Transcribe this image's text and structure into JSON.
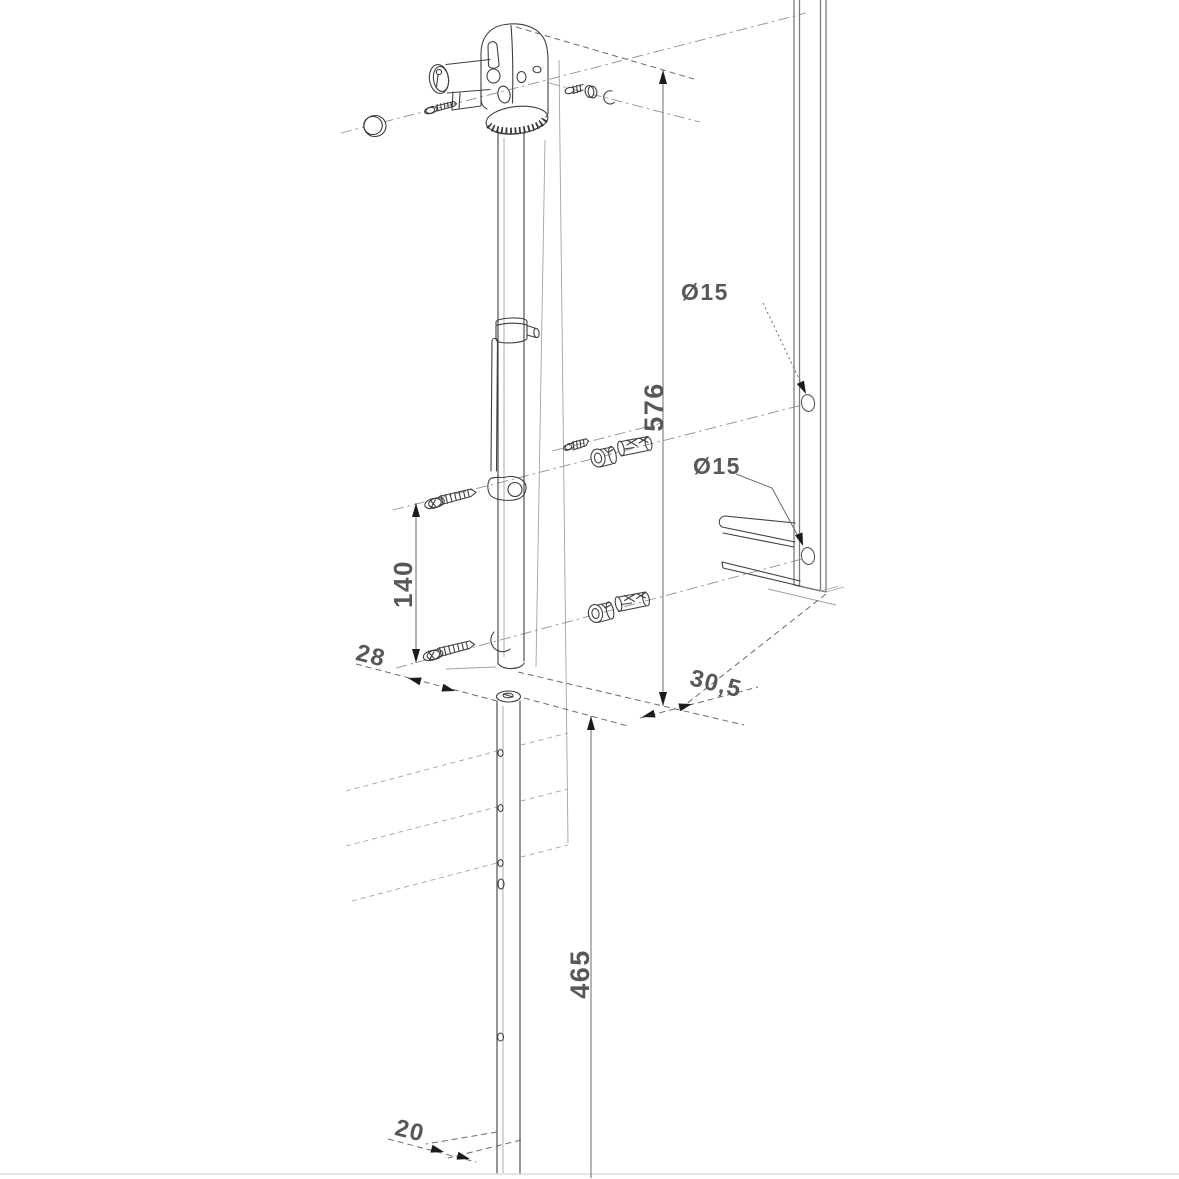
{
  "drawing": {
    "kind": "gate drop-bolt installation diagram",
    "dimensions": {
      "rod_height": "576",
      "tube_height": "465",
      "screw_spacing": "140",
      "offset_front": "28",
      "offset_side": "30,5",
      "tube_width": "20",
      "hole_top": "Ø15",
      "hole_bottom": "Ø15"
    },
    "colors": {
      "part_line": "#3f3f3f",
      "construction": "#a3a3a3",
      "dimension_text": "#57585a",
      "arrow": "#1c1c1c",
      "background": "#ffffff"
    }
  }
}
